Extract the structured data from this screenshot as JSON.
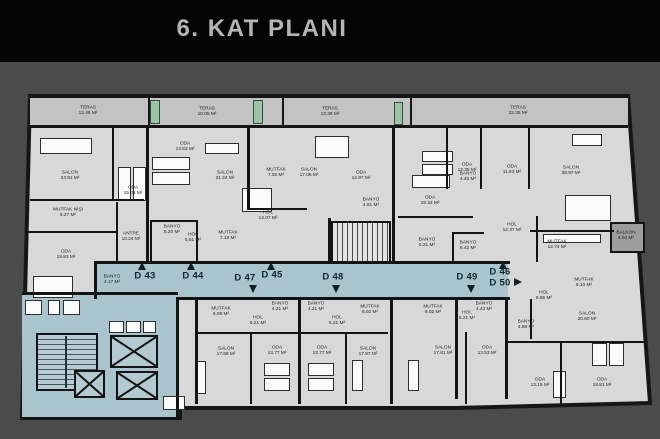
{
  "title": "6. KAT PLANI",
  "colors": {
    "header_bg": "#050505",
    "page_bg": "#4b4b4b",
    "room_fill": "#d8d8d8",
    "terrace_fill": "#c3c3c3",
    "corridor_fill": "#a9c4cc",
    "wall": "#141414",
    "terrace_door_green": "#9cc3a4",
    "balcony_fill": "#9d9d9d"
  },
  "terraces": [
    {
      "label": "TERAS",
      "area": "12.48 M²",
      "x": 88,
      "y": 111
    },
    {
      "label": "TERAS",
      "area": "10.05 M²",
      "x": 207,
      "y": 112
    },
    {
      "label": "TERAS",
      "area": "13.39 M²",
      "x": 330,
      "y": 112
    },
    {
      "label": "TERAS",
      "area": "22.35 M²",
      "x": 518,
      "y": 111
    }
  ],
  "rooms": [
    {
      "label": "SALON",
      "area": "24.91 M²",
      "x": 70,
      "y": 176
    },
    {
      "label": "ODA",
      "area": "15.03 M²",
      "x": 133,
      "y": 191
    },
    {
      "label": "MUTFAK NİŞİ",
      "area": "9.27 M²",
      "x": 68,
      "y": 213
    },
    {
      "label": "ODA",
      "area": "19.83 M²",
      "x": 66,
      "y": 255
    },
    {
      "label": "ANTRE",
      "area": "10.24 M²",
      "x": 131,
      "y": 237
    },
    {
      "label": "BANYO",
      "area": "4.17 M²",
      "x": 112,
      "y": 280
    },
    {
      "label": "ODA",
      "area": "13.53 M²",
      "x": 185,
      "y": 147
    },
    {
      "label": "SALON",
      "area": "21.24 M²",
      "x": 225,
      "y": 176
    },
    {
      "label": "BANYO",
      "area": "5.20 M²",
      "x": 172,
      "y": 230
    },
    {
      "label": "HOL",
      "area": "5.61 M²",
      "x": 193,
      "y": 238
    },
    {
      "label": "MUTFAK",
      "area": "7.05 M²",
      "x": 276,
      "y": 173
    },
    {
      "label": "SALON",
      "area": "17.05 M²",
      "x": 309,
      "y": 173
    },
    {
      "label": "HOL",
      "area": "14.07 M²",
      "x": 268,
      "y": 216
    },
    {
      "label": "MUTFAK",
      "area": "7.19 M²",
      "x": 228,
      "y": 236
    },
    {
      "label": "ODA",
      "area": "14.97 M²",
      "x": 361,
      "y": 176
    },
    {
      "label": "BANYO",
      "area": "4.61 M²",
      "x": 371,
      "y": 203
    },
    {
      "label": "ODA",
      "area": "19.32 M²",
      "x": 430,
      "y": 201
    },
    {
      "label": "ODA",
      "area": "12.35 M²",
      "x": 467,
      "y": 168
    },
    {
      "label": "BANYO",
      "area": "4.46 M²",
      "x": 468,
      "y": 177
    },
    {
      "label": "ODA",
      "area": "11.63 M²",
      "x": 512,
      "y": 170
    },
    {
      "label": "SALON",
      "area": "38.97 M²",
      "x": 571,
      "y": 171
    },
    {
      "label": "HOL",
      "area": "12.37 M²",
      "x": 512,
      "y": 228
    },
    {
      "label": "BANYO",
      "area": "5.21 M²",
      "x": 427,
      "y": 243
    },
    {
      "label": "BANYO",
      "area": "6.42 M²",
      "x": 468,
      "y": 246
    },
    {
      "label": "MUTFAK",
      "area": "12.74 M²",
      "x": 557,
      "y": 245
    },
    {
      "label": "BALKON",
      "area": "4.04 M²",
      "x": 626,
      "y": 236
    },
    {
      "label": "MUTFAK",
      "area": "6.09 M²",
      "x": 221,
      "y": 312
    },
    {
      "label": "HOL",
      "area": "5.21 M²",
      "x": 258,
      "y": 321
    },
    {
      "label": "BANYO",
      "area": "4.21 M²",
      "x": 280,
      "y": 307
    },
    {
      "label": "BANYO",
      "area": "4.21 M²",
      "x": 316,
      "y": 307
    },
    {
      "label": "SALON",
      "area": "17.69 M²",
      "x": 226,
      "y": 352
    },
    {
      "label": "ODA",
      "area": "13.77 M²",
      "x": 277,
      "y": 351
    },
    {
      "label": "ODA",
      "area": "13.77 M²",
      "x": 322,
      "y": 351
    },
    {
      "label": "HOL",
      "area": "5.21 M²",
      "x": 337,
      "y": 321
    },
    {
      "label": "MUTFAK",
      "area": "8.02 M²",
      "x": 370,
      "y": 310
    },
    {
      "label": "SALON",
      "area": "17.97 M²",
      "x": 368,
      "y": 352
    },
    {
      "label": "MUTFAK",
      "area": "8.02 M²",
      "x": 433,
      "y": 310
    },
    {
      "label": "SALON",
      "area": "17.81 M²",
      "x": 443,
      "y": 351
    },
    {
      "label": "HOL",
      "area": "5.21 M²",
      "x": 467,
      "y": 316
    },
    {
      "label": "BANYO",
      "area": "4.43 M²",
      "x": 484,
      "y": 307
    },
    {
      "label": "ODA",
      "area": "13.53 M²",
      "x": 487,
      "y": 351
    },
    {
      "label": "MUTFAK",
      "area": "6.10 M²",
      "x": 584,
      "y": 283
    },
    {
      "label": "HOL",
      "area": "9.86 M²",
      "x": 544,
      "y": 296
    },
    {
      "label": "SALON",
      "area": "20.60 M²",
      "x": 587,
      "y": 317
    },
    {
      "label": "BANYO",
      "area": "4.88 M²",
      "x": 526,
      "y": 325
    },
    {
      "label": "ODA",
      "area": "13.15 M²",
      "x": 540,
      "y": 383
    },
    {
      "label": "ODA",
      "area": "18.81 M²",
      "x": 602,
      "y": 383
    }
  ],
  "units": [
    {
      "label": "D 43",
      "x": 145,
      "y": 276,
      "arrow": "up",
      "ax": 138,
      "ay": 262
    },
    {
      "label": "D 44",
      "x": 193,
      "y": 276,
      "arrow": "up",
      "ax": 187,
      "ay": 262
    },
    {
      "label": "D 47",
      "x": 245,
      "y": 278,
      "arrow": "down",
      "ax": 249,
      "ay": 285
    },
    {
      "label": "D 45",
      "x": 272,
      "y": 275,
      "arrow": "up",
      "ax": 267,
      "ay": 262
    },
    {
      "label": "D 48",
      "x": 333,
      "y": 277,
      "arrow": "down",
      "ax": 332,
      "ay": 285
    },
    {
      "label": "D 49",
      "x": 467,
      "y": 277,
      "arrow": "down",
      "ax": 467,
      "ay": 285
    },
    {
      "label": "D 46",
      "x": 500,
      "y": 272,
      "arrow": "up",
      "ax": 499,
      "ay": 261
    },
    {
      "label": "D 50",
      "x": 500,
      "y": 283,
      "arrow": "right",
      "ax": 514,
      "ay": 278
    }
  ]
}
